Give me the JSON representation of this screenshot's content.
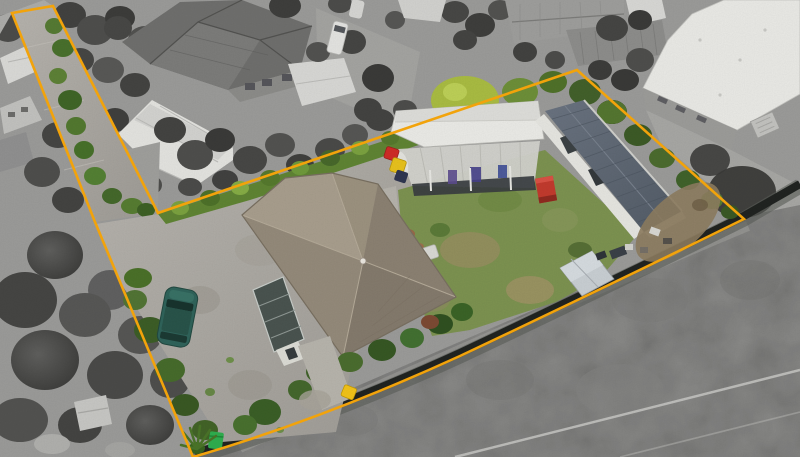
{
  "scene": {
    "kind": "aerial-drone-photo",
    "subject": "residential-property-with-highlighted-boundary",
    "effect": "surroundings-desaturated-grayscale, parcel-in-color"
  },
  "colors": {
    "boundary": "#F2A30B",
    "marker_yellow": "#F2C318",
    "bin_red": "#CF2B26",
    "bin_yellow": "#E8C21C",
    "bin_navy": "#2E3550",
    "bin_green": "#2FAE4E",
    "container_red": "#C23A2D",
    "car_teal": "#2F635A",
    "house_roof": "#9A9080",
    "garage_roof": "#EBEBE7",
    "sleepout_roof": "#5D6672",
    "shed_roof": "#C9CFD3",
    "conservatory": "#49534F",
    "lawn": "#7C9250",
    "hedge": "#5F8433",
    "concrete": "#AEABA4",
    "field_gray": "#8F8F8D",
    "fence_dark": "#202320"
  }
}
